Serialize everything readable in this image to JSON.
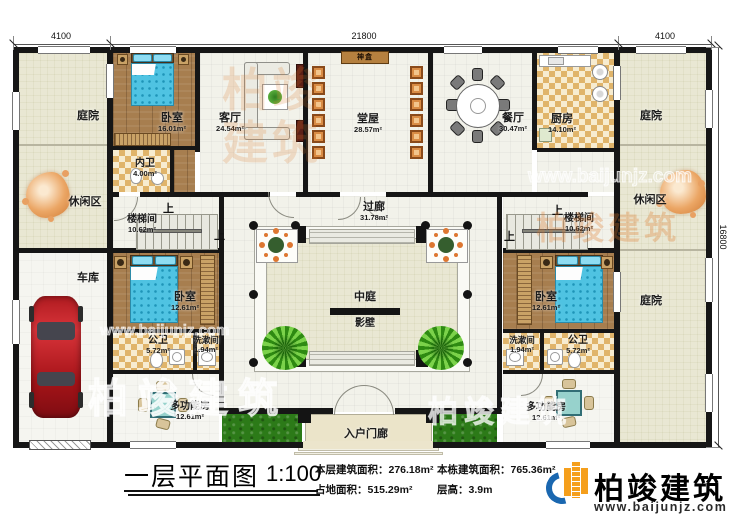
{
  "dims": {
    "top_left": "4100",
    "top_center": "21800",
    "top_right": "4100",
    "right": "16800"
  },
  "up_label": "上",
  "rooms": {
    "courtyard_tl": {
      "name": "庭院"
    },
    "courtyard_tr": {
      "name": "庭院"
    },
    "courtyard_br": {
      "name": "庭院"
    },
    "leisure_left": {
      "name": "休闲区"
    },
    "leisure_right": {
      "name": "休闲区"
    },
    "garage": {
      "name": "车库"
    },
    "bedroom_tl": {
      "name": "卧室",
      "area": "16.01m²"
    },
    "inner_bath": {
      "name": "内卫",
      "area": "4.00m²"
    },
    "living": {
      "name": "客厅",
      "area": "24.54m²"
    },
    "hall": {
      "name": "堂屋",
      "area": "28.57m²"
    },
    "shrine": {
      "name": "神盒"
    },
    "dining": {
      "name": "餐厅",
      "area": "30.47m²"
    },
    "kitchen": {
      "name": "厨房",
      "area": "14.10m²"
    },
    "stair_left": {
      "name": "楼梯间",
      "area": "10.62m²"
    },
    "stair_right": {
      "name": "楼梯间",
      "area": "10.62m²"
    },
    "corridor": {
      "name": "过廊",
      "area": "31.78m²"
    },
    "atrium": {
      "name": "中庭"
    },
    "screen_wall": {
      "name": "影壁"
    },
    "bedroom_left": {
      "name": "卧室",
      "area": "12.61m²"
    },
    "bedroom_right": {
      "name": "卧室",
      "area": "12.61m²"
    },
    "pubbath_left": {
      "name": "公卫",
      "area": "5.72m²"
    },
    "pubbath_right": {
      "name": "公卫",
      "area": "5.72m²"
    },
    "wash_left": {
      "name": "洗漱间",
      "area": "1.94m²"
    },
    "wash_right": {
      "name": "洗漱间",
      "area": "1.94m²"
    },
    "multi_left": {
      "name": "多功能房",
      "area": "12.61m²"
    },
    "multi_right": {
      "name": "多功能房",
      "area": "12.61m²"
    },
    "porch": {
      "name": "入户门廊"
    }
  },
  "titlebar": {
    "title": "一层平面图",
    "scale": "1:100",
    "stat1_label": "本层建筑面积：",
    "stat1_value": "276.18m²",
    "stat2_label": "本栋建筑面积：",
    "stat2_value": "765.36m²",
    "stat3_label": "占地面积：",
    "stat3_value": "515.29m²",
    "stat4_label": "层高：",
    "stat4_value": "3.9m",
    "logo_name": "柏竣建筑",
    "logo_url": "www.baijunjz.com"
  },
  "watermark": {
    "brand": "柏竣建筑",
    "url": "www.baijunjz.com"
  },
  "colors": {
    "brand_blue": "#1a67b0",
    "brand_orange": "#f59f1c",
    "wall_black": "#161616",
    "grass_green": "#2c7a18"
  }
}
